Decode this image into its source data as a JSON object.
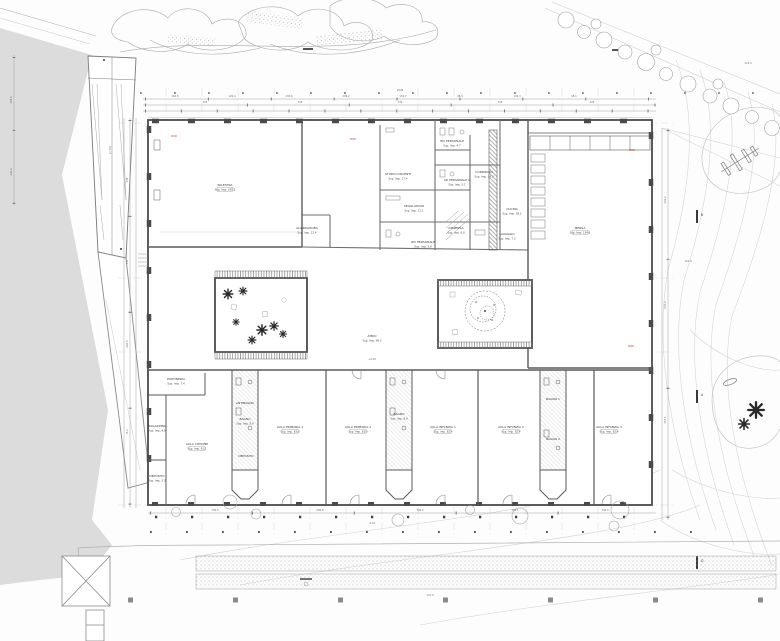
{
  "drawing_type": "architectural-ground-floor-plan",
  "colors": {
    "wall": "#4a4a4a",
    "partition": "#6e6e6e",
    "detail": "#9a9a9a",
    "grid": "#cccccc",
    "ground_fill": "#dcdcdc",
    "vegetation": "#a8a8a8",
    "contour": "#d2d2d2",
    "red_marker": "#c0392b"
  },
  "rooms": [
    {
      "name": "PALESTRA",
      "area": "Sup. Imp. 190.5"
    },
    {
      "name": "GUARDAROBA",
      "area": "Sup. Imp. 12.4"
    },
    {
      "name": "STUDIO DOCENTI",
      "area": "Sup. Imp. 17.4"
    },
    {
      "name": "WC PERSONALE",
      "area": "Sup. Imp. 4.7"
    },
    {
      "name": "SP. PERSONALE 1",
      "area": "Sup. Imp. 5.1"
    },
    {
      "name": "CORRIDOIO",
      "area": "Sup. Imp. 14.3"
    },
    {
      "name": "SPOGLIATOIO",
      "area": "Sup. Imp. 11.1"
    },
    {
      "name": "CUCINA",
      "area": "Sup. Imp. 38.2"
    },
    {
      "name": "DISPENSA",
      "area": "Sup. Imp. 6.8"
    },
    {
      "name": "WC PERSONALE",
      "area": "Sup. Imp. 3.9"
    },
    {
      "name": "LAVAGGIO",
      "area": "Sup. Imp. 7.5"
    },
    {
      "name": "MENSA",
      "area": "Sup. Imp. 134.6"
    },
    {
      "name": "PORTINERIA",
      "area": "Sup. Imp. 7.4"
    },
    {
      "name": "MAGAZZINO",
      "area": "Sup. Imp. 4.5"
    },
    {
      "name": "DEPOSITO",
      "area": "Sup. Imp. 5.2"
    },
    {
      "name": "AULA COMUNE",
      "area": "Sup. Imp. 61.1"
    },
    {
      "name": "ANTIBAGNO",
      "area": "Sup. Imp. 3.4"
    },
    {
      "name": "BAGNO",
      "area": "Sup. Imp. 8.9"
    },
    {
      "name": "DEPOSITO",
      "area": "Sup. Imp. 4.1"
    },
    {
      "name": "AULA PRIMARIA 1",
      "area": "Sup. Imp. 63.8"
    },
    {
      "name": "AULA PRIMARIA 2",
      "area": "Sup. Imp. 63.8"
    },
    {
      "name": "BAGNO",
      "area": "Sup. Imp. 8.9"
    },
    {
      "name": "AULA INFANZIA 1",
      "area": "Sup. Imp. 62.4"
    },
    {
      "name": "AULA INFANZIA 2",
      "area": "Sup. Imp. 62.4"
    },
    {
      "name": "BAGNO 1",
      "area": "Sup. Imp. 6.2"
    },
    {
      "name": "BAGNO 2",
      "area": "Sup. Imp. 6.2"
    },
    {
      "name": "AULA INFANZIA 3",
      "area": "Sup. Imp. 62.4"
    },
    {
      "name": "ATRIO",
      "area": "Sup. Imp. 98.2"
    }
  ],
  "dims": {
    "top_total": "2545",
    "top_mid": [
      "425",
      "730",
      "730",
      "730",
      "425"
    ],
    "top_small": [
      "162.5",
      "120.4",
      "135.0",
      "249.2",
      "152.7",
      "98.4",
      "134.3",
      "95.1"
    ],
    "bottom": [
      "730.5",
      "240.6",
      "730.2",
      "180.1",
      "730.4"
    ],
    "left": [
      "138",
      "700",
      "292.5",
      "75.2"
    ],
    "right": [
      "232.2",
      "604.3",
      "454.1"
    ],
    "far_left": [
      "128.6",
      "246.9"
    ]
  },
  "fire_labels": [
    "R90",
    "R90",
    "R90",
    "R90"
  ],
  "levels": [
    "+0.00",
    "-0.02",
    "102.9",
    "103.4",
    "101.8",
    "p=8%"
  ],
  "section_marks": [
    "B",
    "A",
    "D"
  ]
}
